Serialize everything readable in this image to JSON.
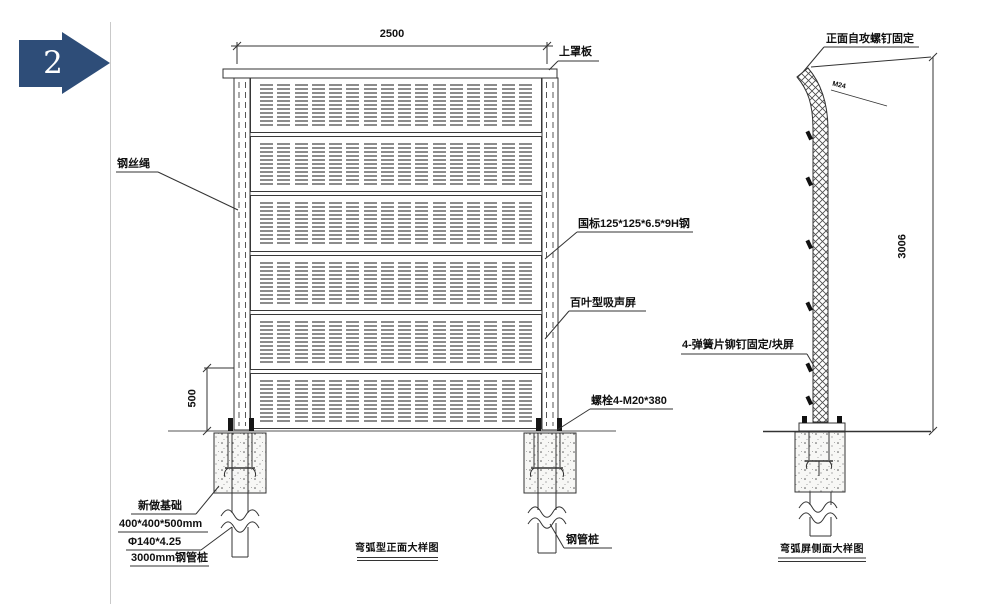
{
  "marker": {
    "number": "2",
    "color": "#2e4d78"
  },
  "front_view": {
    "caption": "弯弧型正面大样图",
    "dim_width": "2500",
    "dim_height_lower": "500",
    "panel": {
      "rows": 6,
      "columns": 16
    },
    "labels": {
      "top_cover_plate": "上罩板",
      "steel_wire_rope": "钢丝绳",
      "h_steel": "国标125*125*6.5*9H钢",
      "louver_screen": "百叶型吸声屏",
      "anchor_bolts": "螺栓4-M20*380",
      "new_foundation": "新做基础",
      "foundation_size": "400*400*500mm",
      "pipe_spec": "Φ140*4.25",
      "pipe_length": "3000mm钢管桩",
      "steel_pipe_pile": "钢管桩"
    }
  },
  "side_view": {
    "caption": "弯弧屏侧面大样图",
    "dim_height": "3006",
    "labels": {
      "self_tapping_screw": "正面自攻螺钉固定",
      "spring_clip": "4-弹簧片铆钉固定/块屏",
      "bolt_note": "M24"
    }
  }
}
